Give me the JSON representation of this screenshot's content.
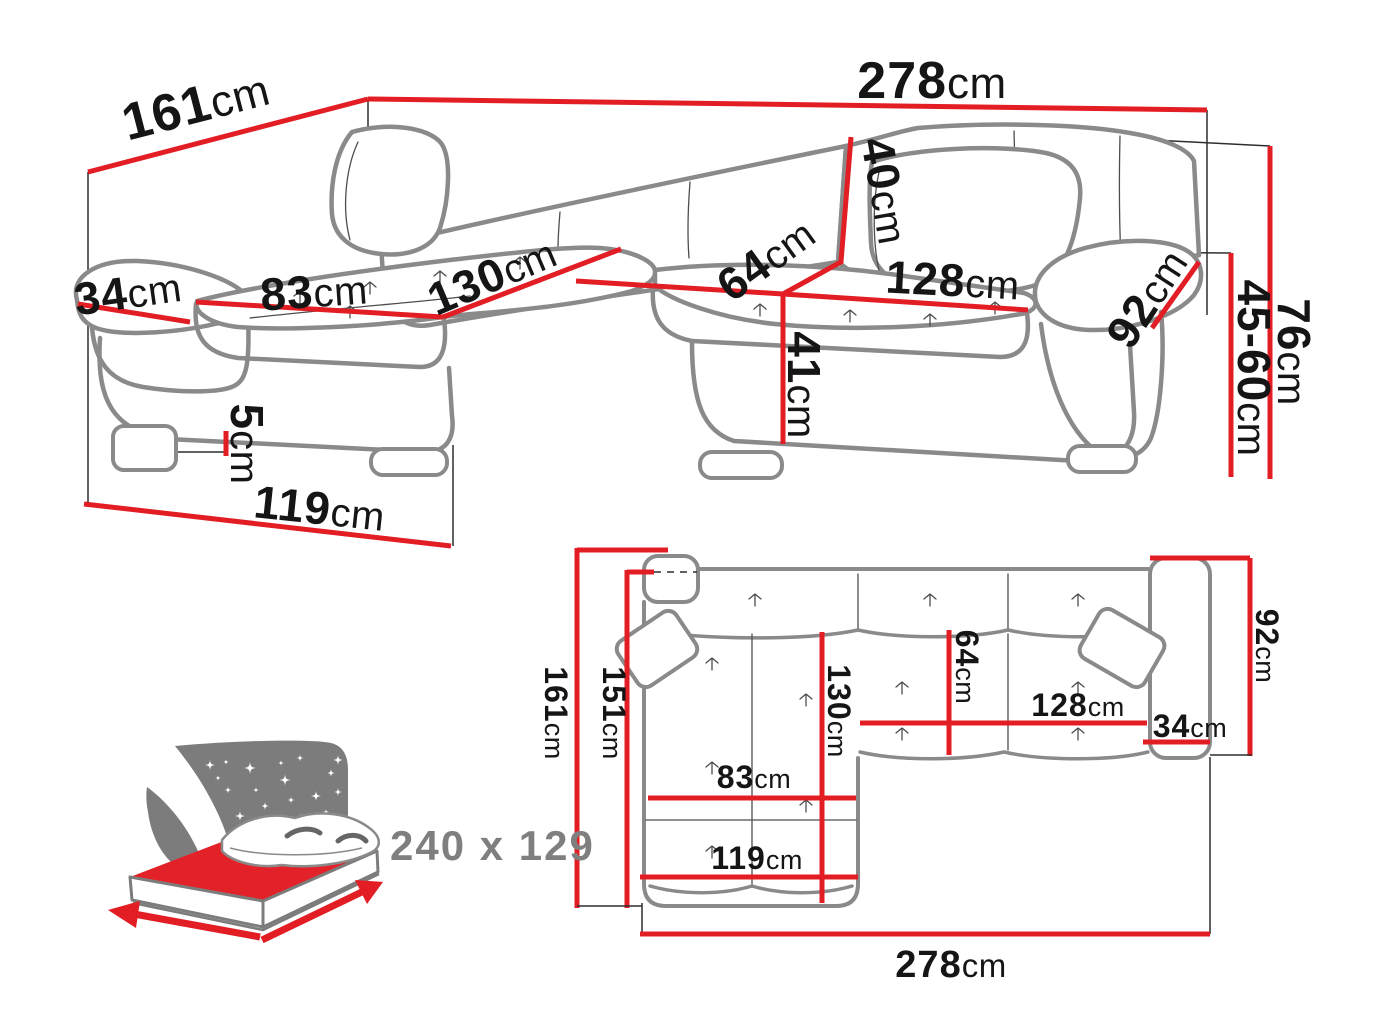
{
  "colors": {
    "dimension_red": "#e21d24",
    "outline_gray": "#8a8a8a",
    "icon_gray": "#7c7c7c",
    "mattress_red": "#e32128",
    "label_gray": "#7f7f7f"
  },
  "perspective": {
    "back_width": {
      "value": "278",
      "unit": "cm"
    },
    "side_depth": {
      "value": "161",
      "unit": "cm"
    },
    "armrest_width": {
      "value": "34",
      "unit": "cm"
    },
    "chaise_seat_width": {
      "value": "83",
      "unit": "cm"
    },
    "chaise_length": {
      "value": "130",
      "unit": "cm"
    },
    "backrest_height": {
      "value": "40",
      "unit": "cm"
    },
    "seat_depth": {
      "value": "64",
      "unit": "cm"
    },
    "main_seat_width": {
      "value": "128",
      "unit": "cm"
    },
    "armrest_length": {
      "value": "92",
      "unit": "cm"
    },
    "total_height": {
      "value": "76",
      "unit": "cm"
    },
    "armrest_height": {
      "value": "45-60",
      "unit": "cm"
    },
    "seat_height": {
      "value": "41",
      "unit": "cm"
    },
    "leg_height": {
      "value": "5",
      "unit": "cm"
    },
    "chaise_base_length": {
      "value": "119",
      "unit": "cm"
    }
  },
  "top_view": {
    "total_depth": {
      "value": "161",
      "unit": "cm"
    },
    "inner_depth": {
      "value": "151",
      "unit": "cm"
    },
    "chaise_length": {
      "value": "130",
      "unit": "cm"
    },
    "seat_depth": {
      "value": "64",
      "unit": "cm"
    },
    "main_seat_width": {
      "value": "128",
      "unit": "cm"
    },
    "armrest_width": {
      "value": "34",
      "unit": "cm"
    },
    "armrest_depth": {
      "value": "92",
      "unit": "cm"
    },
    "chaise_seat_width": {
      "value": "83",
      "unit": "cm"
    },
    "chaise_base_length": {
      "value": "119",
      "unit": "cm"
    },
    "total_width": {
      "value": "278",
      "unit": "cm"
    }
  },
  "sleeping_area": {
    "dimensions": "240 x 129"
  }
}
